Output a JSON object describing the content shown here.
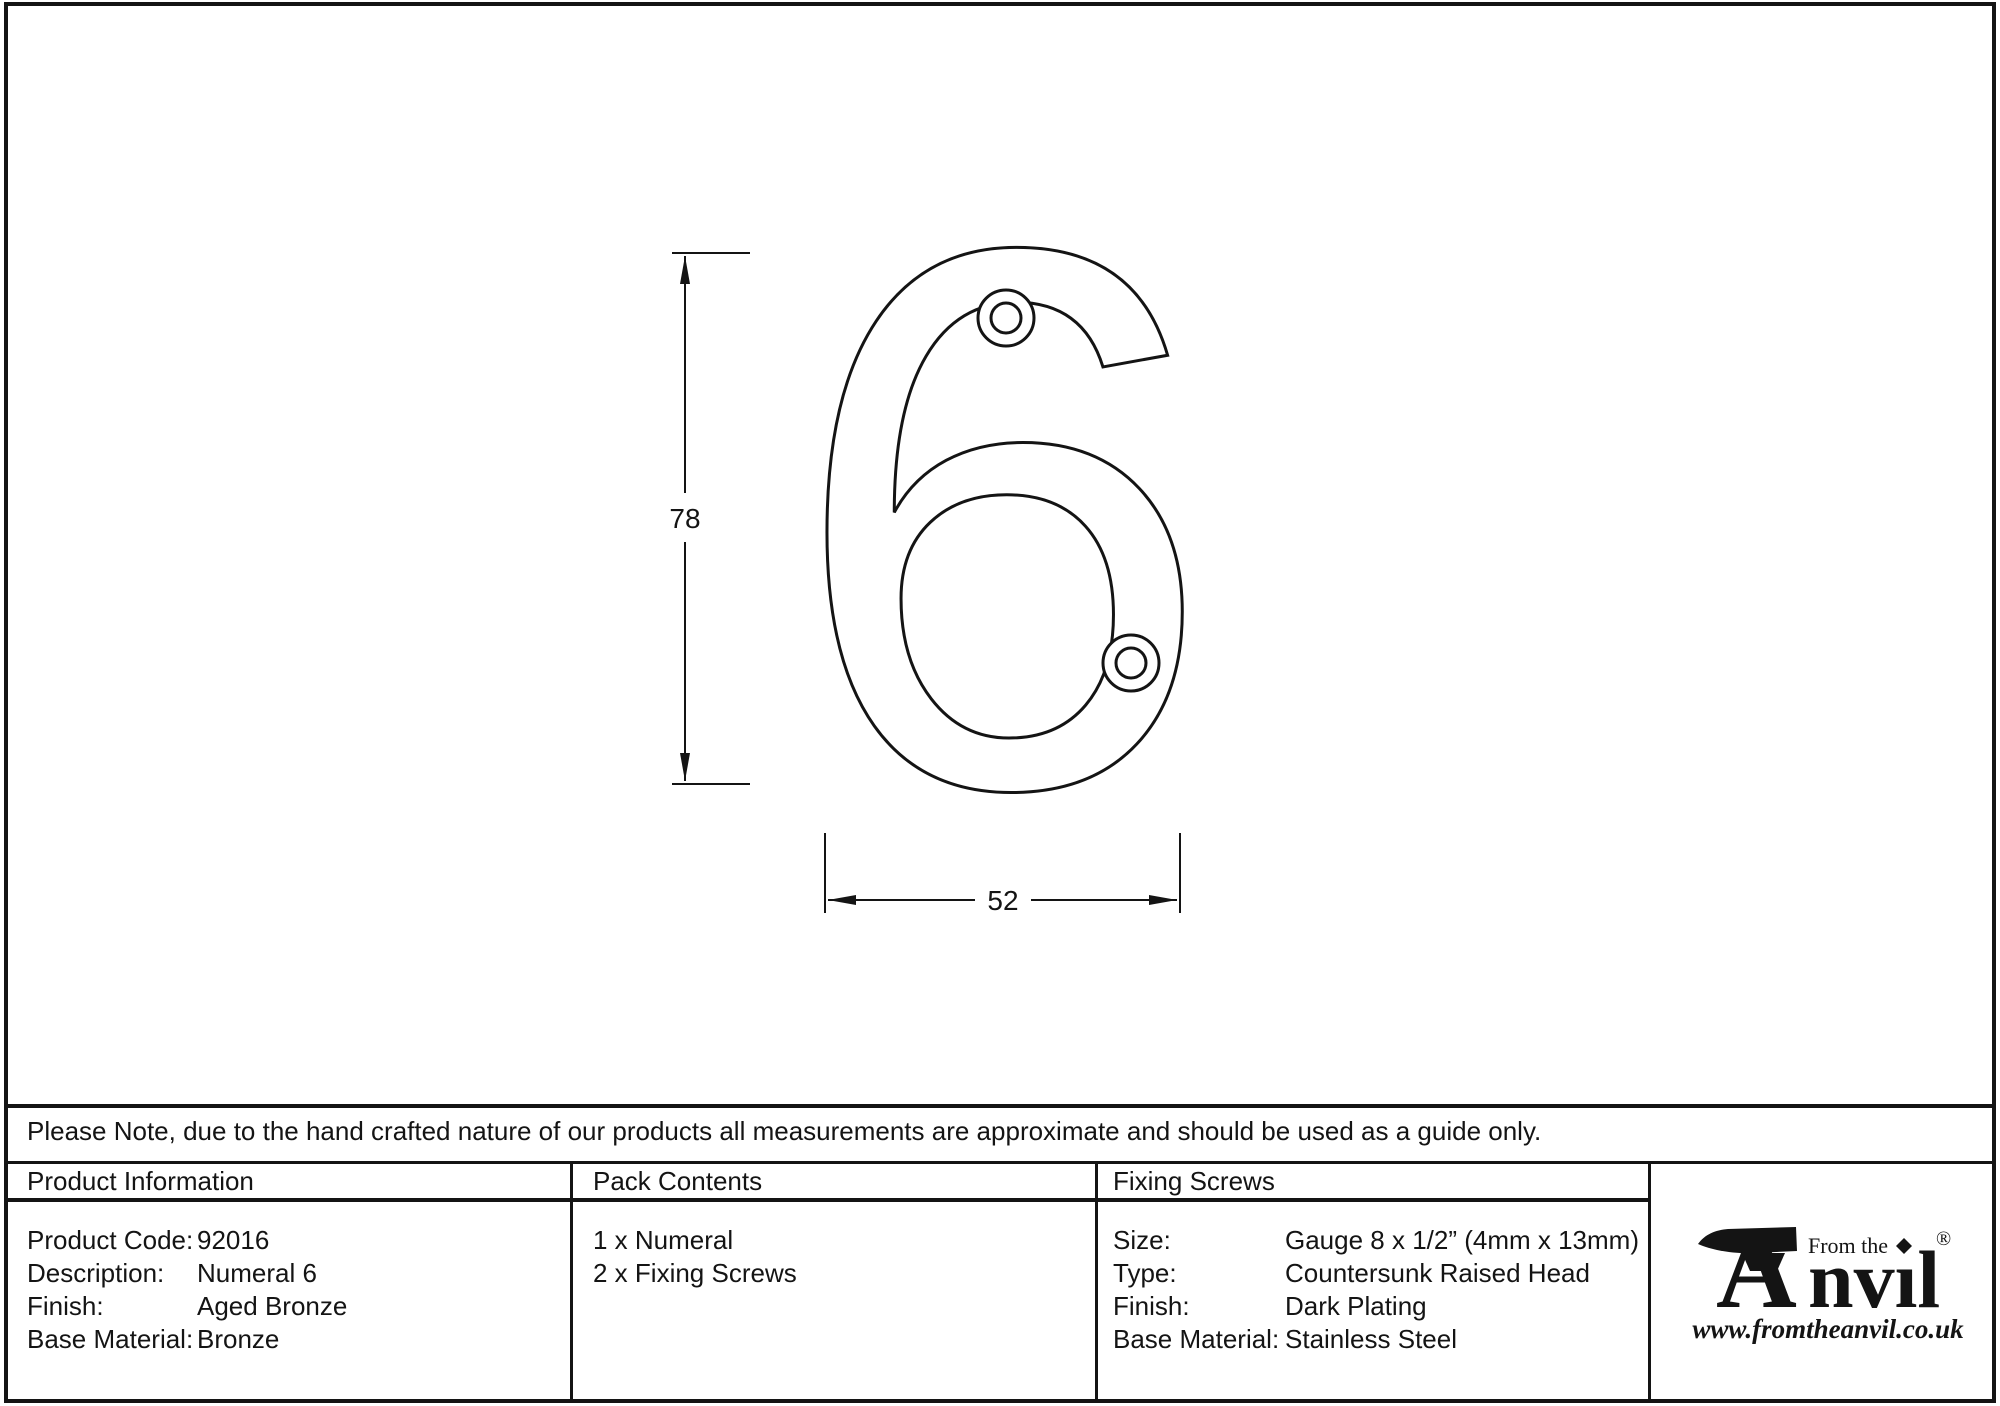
{
  "drawing": {
    "numeral_label": "6",
    "height_dim_label": "78",
    "width_dim_label": "52"
  },
  "note_bar": {
    "text": "Please Note, due to the hand crafted nature of our products all measurements are approximate and should be used as a guide only."
  },
  "product_info": {
    "header": "Product Information",
    "rows": [
      {
        "label": "Product Code:",
        "value": "92016"
      },
      {
        "label": "Description:",
        "value": "Numeral 6"
      },
      {
        "label": "Finish:",
        "value": "Aged Bronze"
      },
      {
        "label": "Base Material:",
        "value": "Bronze"
      }
    ]
  },
  "pack_contents": {
    "header": "Pack Contents",
    "items": [
      "1 x Numeral",
      "2 x Fixing Screws"
    ]
  },
  "fixing_screws": {
    "header": "Fixing Screws",
    "rows": [
      {
        "label": "Size:",
        "value": "Gauge 8 x 1/2” (4mm x 13mm)"
      },
      {
        "label": "Type:",
        "value": "Countersunk Raised Head"
      },
      {
        "label": "Finish:",
        "value": "Dark Plating"
      },
      {
        "label": "Base Material:",
        "value": "Stainless Steel"
      }
    ]
  },
  "logo": {
    "tagline": "From the",
    "brand_initial": "A",
    "brand_rest": "nvıl",
    "registered_mark": "®",
    "website": "www.fromtheanvil.co.uk"
  },
  "colors": {
    "line": "#141414",
    "background": "#ffffff"
  }
}
